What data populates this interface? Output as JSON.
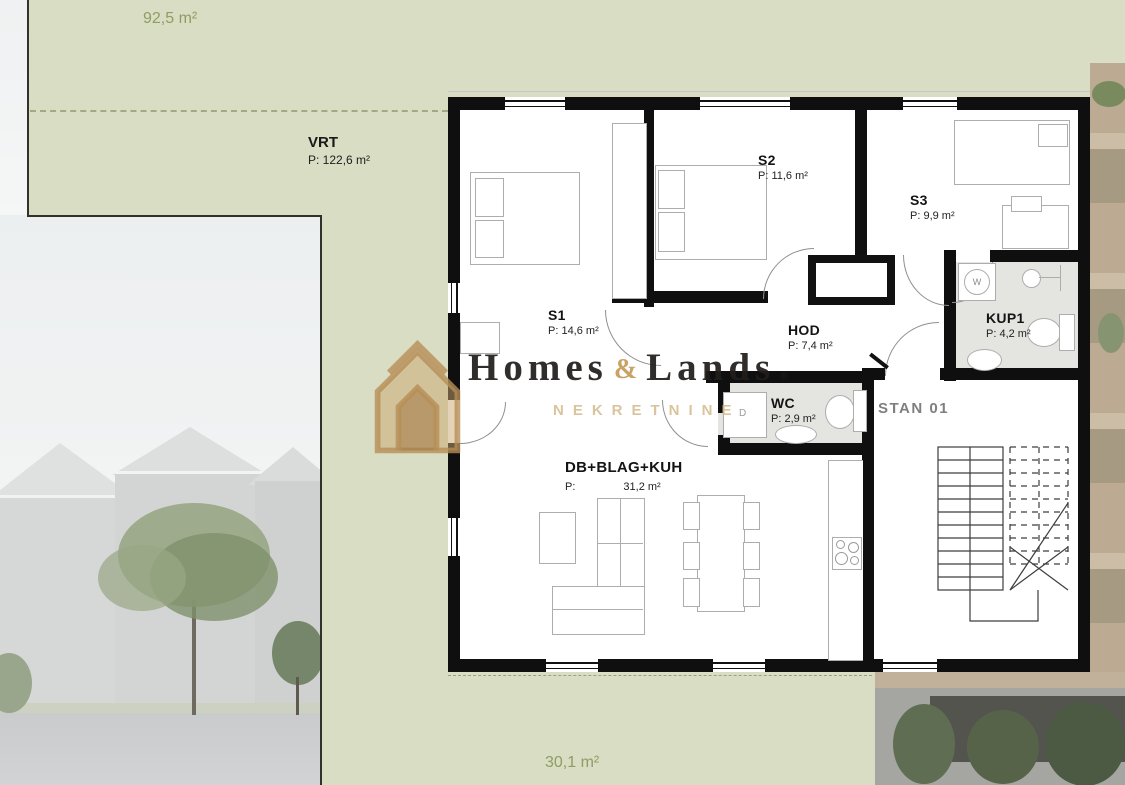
{
  "site": {
    "area_top_label": "92,5 m²",
    "area_bottom_label": "30,1 m²",
    "garden": {
      "name": "VRT",
      "area": "P: 122,6 m²"
    }
  },
  "unit_label": "STAN 01",
  "rooms": [
    {
      "name": "S1",
      "area": "P: 14,6 m²"
    },
    {
      "name": "S2",
      "area": "P: 11,6 m²"
    },
    {
      "name": "S3",
      "area": "P: 9,9 m²"
    },
    {
      "name": "HOD",
      "area": "P: 7,4 m²"
    },
    {
      "name": "KUP1",
      "area": "P: 4,2 m²"
    },
    {
      "name": "WC",
      "area": "P: 2,9 m²"
    },
    {
      "name": "DB+BLAG+KUH",
      "area_prefix": "P:",
      "area_value": "31,2 m²"
    }
  ],
  "appliances": {
    "washer": "W",
    "dryer": "D"
  },
  "watermark": {
    "word1": "Homes",
    "amp": "&",
    "word2": "Lands",
    "registered": "®",
    "subtitle": "NEKRETNINE"
  },
  "colors": {
    "site_green": "#d9ddc3",
    "label_green": "#8f9c64",
    "wall_black": "#0f0f0f",
    "watermark_gold": "#c8a772",
    "bath_floor": "#e4e4e1"
  }
}
